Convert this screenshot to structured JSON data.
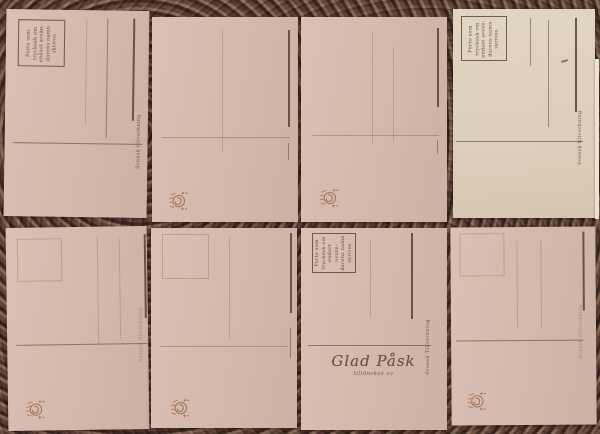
{
  "scene": {
    "description": "Photograph of eight blank antique Swedish postcard backs arranged in two rows of four on a dark mottled fabric background; cards are rotated 90 degrees (portrait), each with a stamp box, address rules and divider line"
  },
  "colors": {
    "background_base": "#5c4238",
    "background_dark": "#2f1f19",
    "background_light": "#a98a76",
    "card_pink": "#d5bbaf",
    "card_cream": "#ded2c0",
    "card_edge_highlight": "#ece3d2",
    "rule_strong": "#564539",
    "rule_faint": "#8a6f5e",
    "ink": "#5a4034",
    "emblem_gold": "#9a6742"
  },
  "strings": {
    "stamp_box_notice": "Porto som\ntrycksak om\nendast avsän-\ndarens namn\nskrives",
    "maker_mark": "Svensk tillverkning",
    "maker_mark_caps": "Svensk Tillverkning",
    "easter_greeting": "Glad Påsk",
    "easter_greeting_sub": "tillönskas av"
  },
  "cards": [
    {
      "position": "top-left",
      "stamp_box": "printed notice",
      "address_rules": 3,
      "maker_mark": true,
      "emblem": false
    },
    {
      "position": "top-center-left",
      "stamp_box": "none visible",
      "address_rules": 2,
      "maker_mark": false,
      "emblem": true
    },
    {
      "position": "top-center-right",
      "stamp_box": "none visible",
      "address_rules": 3,
      "maker_mark": false,
      "emblem": true
    },
    {
      "position": "top-right",
      "stamp_box": "printed notice",
      "address_rules": 3,
      "maker_mark": true,
      "emblem": false,
      "note": "lighter cream card with small pencil dash"
    },
    {
      "position": "bottom-left",
      "stamp_box": "blind embossed",
      "address_rules": 3,
      "maker_mark": true,
      "emblem": true
    },
    {
      "position": "bottom-center-left",
      "stamp_box": "blind embossed",
      "address_rules": 3,
      "maker_mark": false,
      "emblem": true
    },
    {
      "position": "bottom-center-right",
      "stamp_box": "printed notice",
      "address_rules": 2,
      "maker_mark": true,
      "emblem": false,
      "greeting": "Glad Påsk tillönskas av"
    },
    {
      "position": "bottom-right",
      "stamp_box": "blind embossed",
      "address_rules": 3,
      "maker_mark": true,
      "emblem": true
    }
  ]
}
